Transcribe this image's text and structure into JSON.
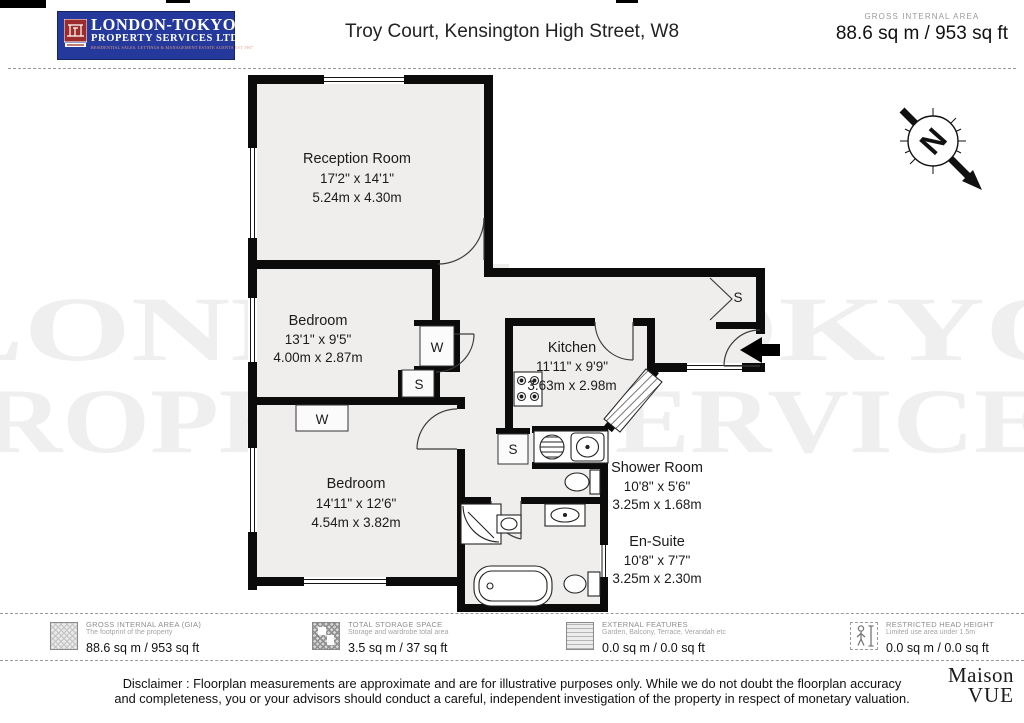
{
  "header": {
    "logo_line1": "LONDON-TOKYO",
    "logo_line2": "PROPERTY SERVICES LTD.",
    "logo_line3": "RESIDENTIAL SALES, LETTINGS & MANAGEMENT ESTATE AGENTS EST 1987",
    "title": "Troy Court, Kensington High Street, W8",
    "gia_label": "GROSS INTERNAL AREA",
    "gia_value": "88.6 sq m / 953 sq ft"
  },
  "floorplan": {
    "compass_letter": "N",
    "watermark_line1": "LONDON-TOKYO",
    "watermark_line2": "PROPERTY SERVICES",
    "closets": {
      "wardrobe": "W",
      "storage": "S"
    },
    "rooms": [
      {
        "name": "Reception Room",
        "imperial": "17'2\" x 14'1\"",
        "metric": "5.24m x 4.30m"
      },
      {
        "name": "Bedroom",
        "imperial": "13'1\" x 9'5\"",
        "metric": "4.00m x 2.87m"
      },
      {
        "name": "Kitchen",
        "imperial": "11'11\" x 9'9\"",
        "metric": "3.63m x 2.98m"
      },
      {
        "name": "Bedroom",
        "imperial": "14'11\" x 12'6\"",
        "metric": "4.54m x 3.82m"
      },
      {
        "name": "Shower Room",
        "imperial": "10'8\" x 5'6\"",
        "metric": "3.25m x 1.68m"
      },
      {
        "name": "En-Suite",
        "imperial": "10'8\" x 7'7\"",
        "metric": "3.25m x 2.30m"
      }
    ]
  },
  "legend": {
    "items": [
      {
        "title": "GROSS INTERNAL AREA (GIA)",
        "subtitle": "The footprint of the property",
        "value": "88.6 sq m / 953 sq ft"
      },
      {
        "title": "TOTAL STORAGE SPACE",
        "subtitle": "Storage and wardrobe total area",
        "value": "3.5 sq m / 37 sq ft"
      },
      {
        "title": "EXTERNAL FEATURES",
        "subtitle": "Garden, Balcony, Terrace, Verandah etc",
        "value": "0.0 sq m / 0.0 sq ft"
      },
      {
        "title": "RESTRICTED HEAD HEIGHT",
        "subtitle": "Limited use area under 1.5m",
        "value": "0.0 sq m / 0.0 sq ft"
      }
    ]
  },
  "footer": {
    "disclaimer_line1": "Disclaimer : Floorplan measurements are approximate and are for illustrative purposes only. While we do not doubt the floorplan accuracy",
    "disclaimer_line2": "and completeness, you or your advisors should conduct a careful, independent investigation of the property in respect of monetary valuation.",
    "brand_line1": "Maison",
    "brand_line2": "VUE"
  }
}
